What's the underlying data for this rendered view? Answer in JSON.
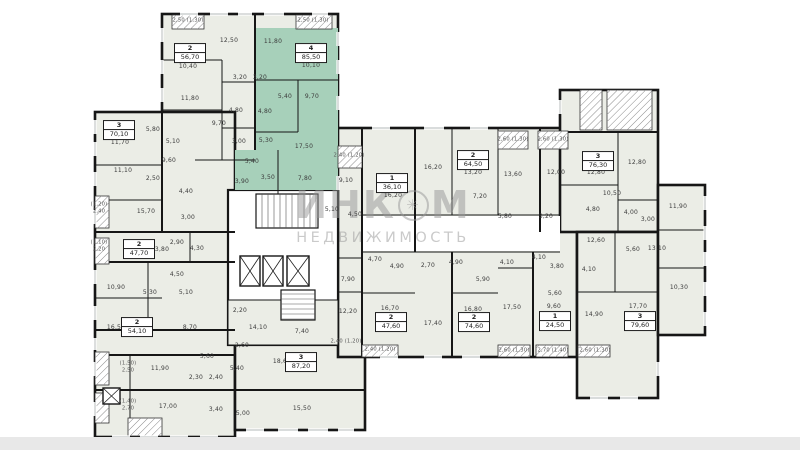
{
  "plan": {
    "watermark": {
      "part1": "ИНК",
      "logo": "✳",
      "part2": "М",
      "line2": "НЕДВИЖИМОСТЬ"
    },
    "colors": {
      "highlight": "#a7d0ba",
      "room_fill": "#ebede6",
      "wall": "#161616",
      "label": "#3b3b3b"
    },
    "apartments": [
      {
        "number": "2",
        "area": "56,70",
        "x": 190,
        "y": 53
      },
      {
        "number": "4",
        "area": "85,50",
        "x": 311,
        "y": 53,
        "highlighted": true
      },
      {
        "number": "3",
        "area": "70,10",
        "x": 119,
        "y": 130
      },
      {
        "number": "2",
        "area": "47,70",
        "x": 139,
        "y": 249
      },
      {
        "number": "2",
        "area": "54,10",
        "x": 137,
        "y": 327
      },
      {
        "number": "3",
        "area": "87,20",
        "x": 301,
        "y": 362
      },
      {
        "number": "1",
        "area": "36,10",
        "x": 392,
        "y": 183
      },
      {
        "number": "2",
        "area": "64,50",
        "x": 473,
        "y": 160
      },
      {
        "number": "3",
        "area": "76,30",
        "x": 598,
        "y": 161
      },
      {
        "number": "2",
        "area": "47,60",
        "x": 391,
        "y": 322
      },
      {
        "number": "2",
        "area": "74,60",
        "x": 474,
        "y": 322
      },
      {
        "number": "1",
        "area": "24,50",
        "x": 555,
        "y": 321
      },
      {
        "number": "3",
        "area": "79,60",
        "x": 640,
        "y": 321
      }
    ],
    "room_labels": [
      {
        "t": "12,50",
        "x": 229,
        "y": 41
      },
      {
        "t": "10,40",
        "x": 188,
        "y": 67
      },
      {
        "t": "11,80",
        "x": 190,
        "y": 99
      },
      {
        "t": "3,20",
        "x": 240,
        "y": 78
      },
      {
        "t": "4,80",
        "x": 236,
        "y": 111
      },
      {
        "t": "9,70",
        "x": 219,
        "y": 124
      },
      {
        "t": "3,00",
        "x": 239,
        "y": 142
      },
      {
        "t": "11,80",
        "x": 273,
        "y": 42
      },
      {
        "t": "10,10",
        "x": 311,
        "y": 66
      },
      {
        "t": "3,20",
        "x": 260,
        "y": 78
      },
      {
        "t": "5,40",
        "x": 285,
        "y": 97
      },
      {
        "t": "9,70",
        "x": 312,
        "y": 97
      },
      {
        "t": "4,80",
        "x": 265,
        "y": 112
      },
      {
        "t": "5,30",
        "x": 266,
        "y": 141
      },
      {
        "t": "17,50",
        "x": 304,
        "y": 147
      },
      {
        "t": "5,40",
        "x": 252,
        "y": 162
      },
      {
        "t": "3,90",
        "x": 242,
        "y": 182
      },
      {
        "t": "3,50",
        "x": 268,
        "y": 178
      },
      {
        "t": "7,80",
        "x": 305,
        "y": 179
      },
      {
        "t": "11,70",
        "x": 120,
        "y": 143
      },
      {
        "t": "5,80",
        "x": 153,
        "y": 130
      },
      {
        "t": "5,10",
        "x": 173,
        "y": 142
      },
      {
        "t": "9,60",
        "x": 169,
        "y": 161
      },
      {
        "t": "11,10",
        "x": 123,
        "y": 171
      },
      {
        "t": "2,50",
        "x": 153,
        "y": 179
      },
      {
        "t": "4,40",
        "x": 186,
        "y": 192
      },
      {
        "t": "15,70",
        "x": 146,
        "y": 212
      },
      {
        "t": "3,00",
        "x": 188,
        "y": 218
      },
      {
        "t": "13,80",
        "x": 160,
        "y": 250
      },
      {
        "t": "2,90",
        "x": 177,
        "y": 243
      },
      {
        "t": "4,30",
        "x": 197,
        "y": 249
      },
      {
        "t": "4,50",
        "x": 177,
        "y": 275
      },
      {
        "t": "10,90",
        "x": 116,
        "y": 288
      },
      {
        "t": "5,30",
        "x": 150,
        "y": 293
      },
      {
        "t": "5,10",
        "x": 186,
        "y": 293
      },
      {
        "t": "16,50",
        "x": 116,
        "y": 328
      },
      {
        "t": "8,70",
        "x": 190,
        "y": 328
      },
      {
        "t": "5,60",
        "x": 207,
        "y": 357
      },
      {
        "t": "11,90",
        "x": 160,
        "y": 369
      },
      {
        "t": "2,30",
        "x": 196,
        "y": 378
      },
      {
        "t": "2,40",
        "x": 216,
        "y": 378
      },
      {
        "t": "5,40",
        "x": 237,
        "y": 369
      },
      {
        "t": "2,60",
        "x": 242,
        "y": 346
      },
      {
        "t": "17,00",
        "x": 168,
        "y": 407
      },
      {
        "t": "3,40",
        "x": 216,
        "y": 410
      },
      {
        "t": "5,00",
        "x": 243,
        "y": 414
      },
      {
        "t": "2,20",
        "x": 240,
        "y": 311
      },
      {
        "t": "14,10",
        "x": 258,
        "y": 328
      },
      {
        "t": "7,40",
        "x": 302,
        "y": 332
      },
      {
        "t": "18,60",
        "x": 282,
        "y": 362
      },
      {
        "t": "15,50",
        "x": 302,
        "y": 409
      },
      {
        "t": "5,10",
        "x": 332,
        "y": 210
      },
      {
        "t": "4,50",
        "x": 355,
        "y": 215
      },
      {
        "t": "9,10",
        "x": 346,
        "y": 181
      },
      {
        "t": "16,20",
        "x": 393,
        "y": 196
      },
      {
        "t": "16,20",
        "x": 433,
        "y": 168
      },
      {
        "t": "13,20",
        "x": 473,
        "y": 173
      },
      {
        "t": "7,20",
        "x": 480,
        "y": 197
      },
      {
        "t": "13,60",
        "x": 513,
        "y": 175
      },
      {
        "t": "5,80",
        "x": 505,
        "y": 217
      },
      {
        "t": "3,20",
        "x": 546,
        "y": 217
      },
      {
        "t": "12,00",
        "x": 556,
        "y": 173
      },
      {
        "t": "12,80",
        "x": 596,
        "y": 173
      },
      {
        "t": "12,80",
        "x": 637,
        "y": 163
      },
      {
        "t": "10,50",
        "x": 612,
        "y": 194
      },
      {
        "t": "4,80",
        "x": 593,
        "y": 210
      },
      {
        "t": "4,00",
        "x": 631,
        "y": 213
      },
      {
        "t": "3,00",
        "x": 648,
        "y": 220
      },
      {
        "t": "11,90",
        "x": 678,
        "y": 207
      },
      {
        "t": "4,70",
        "x": 375,
        "y": 260
      },
      {
        "t": "4,90",
        "x": 397,
        "y": 267
      },
      {
        "t": "2,70",
        "x": 428,
        "y": 266
      },
      {
        "t": "4,90",
        "x": 456,
        "y": 263
      },
      {
        "t": "5,90",
        "x": 483,
        "y": 280
      },
      {
        "t": "16,70",
        "x": 390,
        "y": 309
      },
      {
        "t": "17,40",
        "x": 433,
        "y": 324
      },
      {
        "t": "16,80",
        "x": 473,
        "y": 310
      },
      {
        "t": "17,50",
        "x": 512,
        "y": 308
      },
      {
        "t": "4,10",
        "x": 507,
        "y": 263
      },
      {
        "t": "4,10",
        "x": 539,
        "y": 258
      },
      {
        "t": "3,80",
        "x": 557,
        "y": 267
      },
      {
        "t": "4,10",
        "x": 589,
        "y": 270
      },
      {
        "t": "5,60",
        "x": 555,
        "y": 294
      },
      {
        "t": "9,60",
        "x": 554,
        "y": 307
      },
      {
        "t": "12,60",
        "x": 596,
        "y": 241
      },
      {
        "t": "5,60",
        "x": 633,
        "y": 250
      },
      {
        "t": "13,10",
        "x": 657,
        "y": 249
      },
      {
        "t": "10,30",
        "x": 679,
        "y": 288
      },
      {
        "t": "14,90",
        "x": 594,
        "y": 315
      },
      {
        "t": "17,70",
        "x": 638,
        "y": 307
      },
      {
        "t": "7,90",
        "x": 348,
        "y": 280
      },
      {
        "t": "12,20",
        "x": 348,
        "y": 312
      }
    ],
    "balcony_labels": [
      {
        "t": "2,50 (1,30)",
        "x": 188,
        "y": 21
      },
      {
        "t": "2,50 (1,30)",
        "x": 313,
        "y": 21
      },
      {
        "t": "2,40 (1,20)",
        "x": 349,
        "y": 156
      },
      {
        "t": "2,60 (1,30)",
        "x": 513,
        "y": 140
      },
      {
        "t": "2,60 (1,30)",
        "x": 553,
        "y": 140
      },
      {
        "t": "2,40 (1,20)",
        "x": 346,
        "y": 342
      },
      {
        "t": "2,40 (1,20)",
        "x": 380,
        "y": 350
      },
      {
        "t": "2,60 (1,30)",
        "x": 514,
        "y": 351
      },
      {
        "t": "2,70 (1,40)",
        "x": 553,
        "y": 351
      },
      {
        "t": "2,60 (1,30)",
        "x": 595,
        "y": 351
      },
      {
        "t": "(1,20)",
        "x": 99,
        "y": 205
      },
      {
        "t": "2,40",
        "x": 99,
        "y": 212
      },
      {
        "t": "(1,10)",
        "x": 99,
        "y": 243
      },
      {
        "t": "2,20",
        "x": 99,
        "y": 250
      },
      {
        "t": "(1,50)",
        "x": 128,
        "y": 364
      },
      {
        "t": "2,50",
        "x": 128,
        "y": 371
      },
      {
        "t": "(1,40)",
        "x": 128,
        "y": 402
      },
      {
        "t": "2,70",
        "x": 128,
        "y": 409
      }
    ]
  }
}
